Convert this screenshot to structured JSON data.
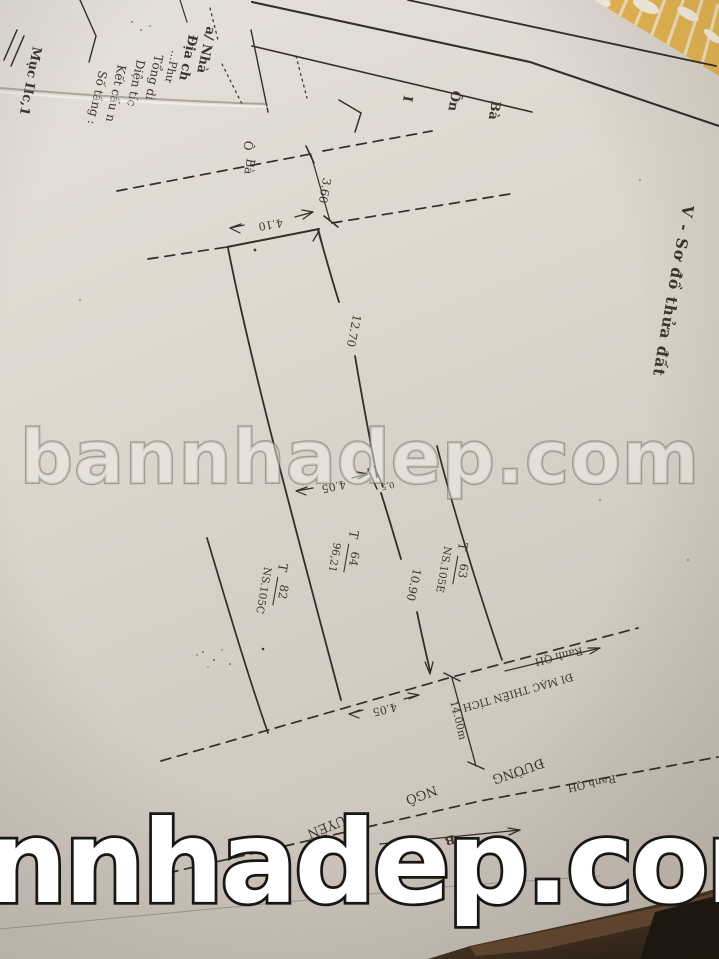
{
  "watermarks": {
    "center": "bannhadep.com",
    "bottom": "nnhadep.com"
  },
  "heading": "V - Sơ đồ thửa đất",
  "back_sheet": {
    "section_label": "Mục IIc,1",
    "rows": [
      "a/ Nhà",
      "Địa ch",
      "...Phư",
      "Tổng di",
      "Diện tíc",
      "Kết cấu n",
      "Số tầng :"
    ],
    "cells": {
      "c0": "I",
      "c1": "Ôn",
      "c2": "Bà",
      "c3": "Ô",
      "c4": "Bà"
    }
  },
  "parcels": [
    {
      "prefix": "T",
      "number": "82",
      "name": "NS.105C"
    },
    {
      "prefix": "T",
      "number": "64",
      "name": "96,21"
    },
    {
      "prefix": "T",
      "number": "63",
      "name": "NS.105E"
    }
  ],
  "dimensions": {
    "rear_offset": "3.60",
    "rear_width": "4.10",
    "side_upper": "12.70",
    "side_lower": "10.90",
    "mid_width": "4.05",
    "mid_jog": "0,5",
    "front_width": "4.05",
    "road_width": "14.00m"
  },
  "road": {
    "street_word": "ĐƯỜNG",
    "street_name_1": "NGÔ",
    "street_name_2": "QUYỀN",
    "direction": "ĐI MẠC THIÊN TÍCH",
    "boundary_label_1": "Ranh QH",
    "boundary_label_2": "Ranh QH",
    "north": "B"
  },
  "colors": {
    "ink": "#332e28",
    "paper": "#d9d3ca",
    "orange_folder": "#e9b854",
    "dark_surface": "#241c14",
    "watermark_white": "#ffffff"
  }
}
